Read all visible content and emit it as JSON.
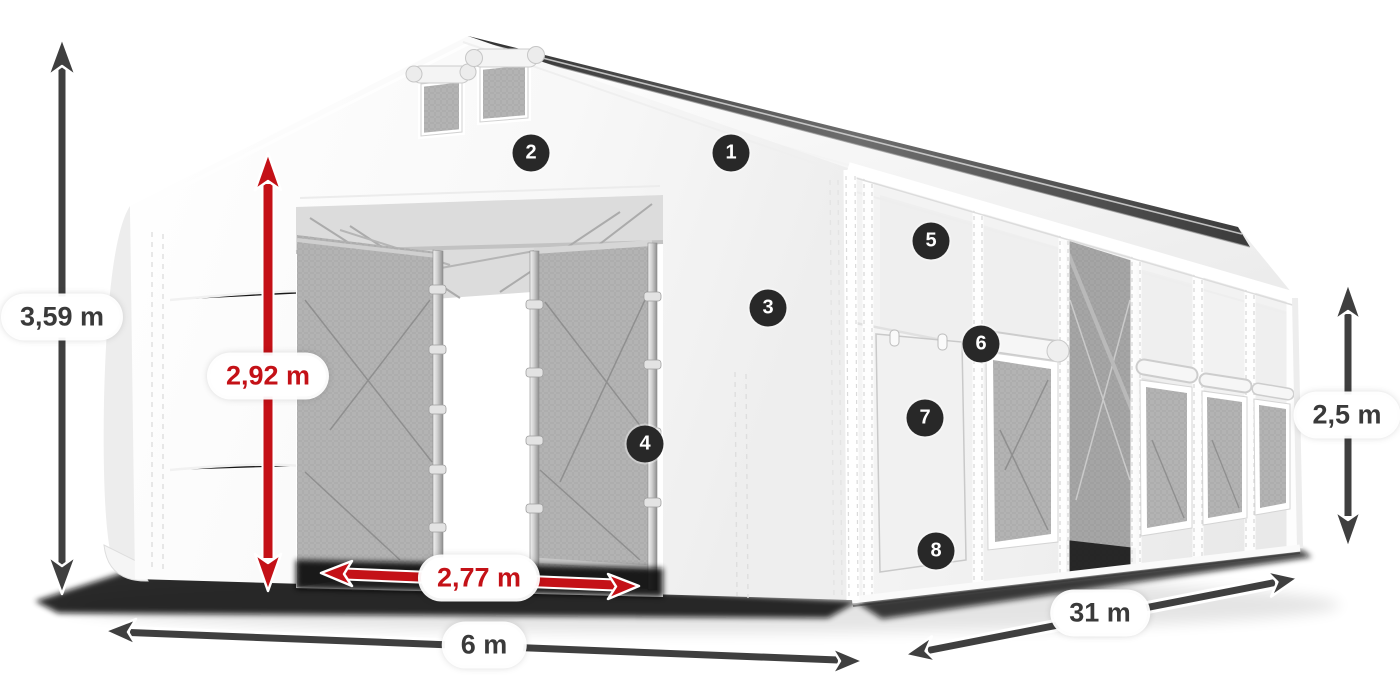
{
  "scene": {
    "background_color": "#ffffff",
    "illustration_name": "storage-tent-3d-render"
  },
  "colors": {
    "scene_bg": "#ffffff",
    "arrow_dark": "#3f3f3f",
    "arrow_red": "#c41117",
    "label_bg": "#ffffff",
    "label_text_dark": "#3a3a3a",
    "label_text_red": "#c41117",
    "badge_bg": "#282828",
    "badge_text": "#ffffff",
    "tent_white": "#f7f7f7",
    "mesh_gray": "#b3b3b3",
    "shadow_black": "#0c0c0c"
  },
  "dimension_labels": [
    {
      "id": "total-height",
      "text": "3,59 m",
      "style": "dark"
    },
    {
      "id": "entry-height",
      "text": "2,92 m",
      "style": "red"
    },
    {
      "id": "entry-width",
      "text": "2,77 m",
      "style": "red"
    },
    {
      "id": "front-width",
      "text": "6 m",
      "style": "dark"
    },
    {
      "id": "side-length",
      "text": "31 m",
      "style": "dark"
    },
    {
      "id": "wall-height",
      "text": "2,5 m",
      "style": "dark"
    }
  ],
  "callout_badges": [
    {
      "number": "1"
    },
    {
      "number": "2"
    },
    {
      "number": "3"
    },
    {
      "number": "4"
    },
    {
      "number": "5"
    },
    {
      "number": "6"
    },
    {
      "number": "7"
    },
    {
      "number": "8"
    }
  ]
}
